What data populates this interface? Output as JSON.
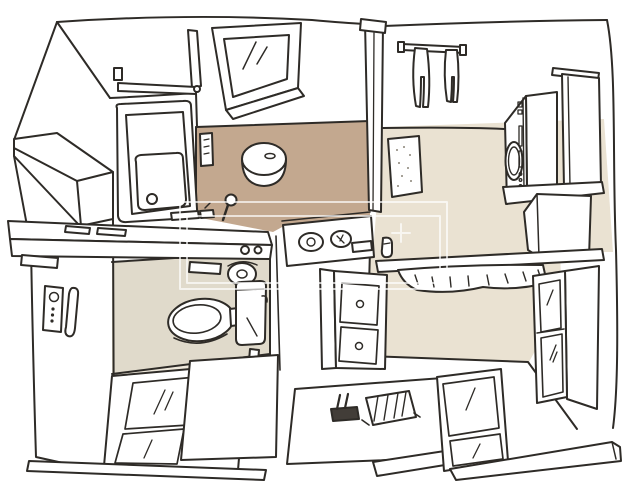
{
  "scene": {
    "description": "Hand-drawn perspective sketch of a compact Japanese-style bathroom suite: bathtub room, wet shower area, laundry corner, toilet room, vanity and dressing area",
    "background": "#ffffff",
    "ink": "#2e2b27",
    "watermark": {
      "style": "translucent double rectangle frame with plus mark",
      "color": "rgba(255,255,255,0.68)"
    },
    "floors": {
      "wet_area": "#c3a88f",
      "laundry_dressing": "#eae2d2",
      "toilet_room": "#e0dacb",
      "toilet_room_edge": "#efe9dc"
    },
    "rooms": [
      {
        "id": "bathroom",
        "label": "bathtub room"
      },
      {
        "id": "wet-area",
        "label": "shower wet area"
      },
      {
        "id": "laundry",
        "label": "laundry corner"
      },
      {
        "id": "toilet-room",
        "label": "toilet room"
      },
      {
        "id": "dressing",
        "label": "vanity and dressing area"
      }
    ],
    "objects": [
      {
        "name": "window",
        "room": "bathroom"
      },
      {
        "name": "towel-bar",
        "room": "bathroom"
      },
      {
        "name": "bathtub",
        "room": "bathroom"
      },
      {
        "name": "shower-stool",
        "room": "wet-area"
      },
      {
        "name": "drain-plug",
        "room": "wet-area"
      },
      {
        "name": "shelf-strip",
        "room": "wet-area"
      },
      {
        "name": "partition-post",
        "room": "center"
      },
      {
        "name": "towel-rail-with-towels",
        "room": "laundry"
      },
      {
        "name": "speckled-wall-mat",
        "room": "laundry"
      },
      {
        "name": "washing-machine",
        "room": "laundry"
      },
      {
        "name": "wall-cabinet",
        "room": "laundry"
      },
      {
        "name": "under-washer-shelf",
        "room": "laundry"
      },
      {
        "name": "over-toilet-counter",
        "room": "toilet-room"
      },
      {
        "name": "toilet-paper-roll",
        "room": "toilet-room"
      },
      {
        "name": "toilet-remote",
        "room": "toilet-room"
      },
      {
        "name": "grab-bar",
        "room": "toilet-room"
      },
      {
        "name": "toilet",
        "room": "toilet-room"
      },
      {
        "name": "washbasin-control-counter",
        "room": "dressing"
      },
      {
        "name": "vanity-drawer-cabinet",
        "room": "dressing"
      },
      {
        "name": "bench-shelf-with-shag-mat",
        "room": "dressing"
      },
      {
        "name": "glass-door-cabinet",
        "room": "dressing"
      },
      {
        "name": "sliding-glass-door",
        "room": "toilet-room"
      },
      {
        "name": "sliding-glass-door",
        "room": "dressing"
      },
      {
        "name": "deck-platform",
        "room": "entry"
      },
      {
        "name": "slippers",
        "room": "entry"
      },
      {
        "name": "drain-rack",
        "room": "entry"
      },
      {
        "name": "floor-threshold",
        "room": "entry"
      }
    ]
  }
}
